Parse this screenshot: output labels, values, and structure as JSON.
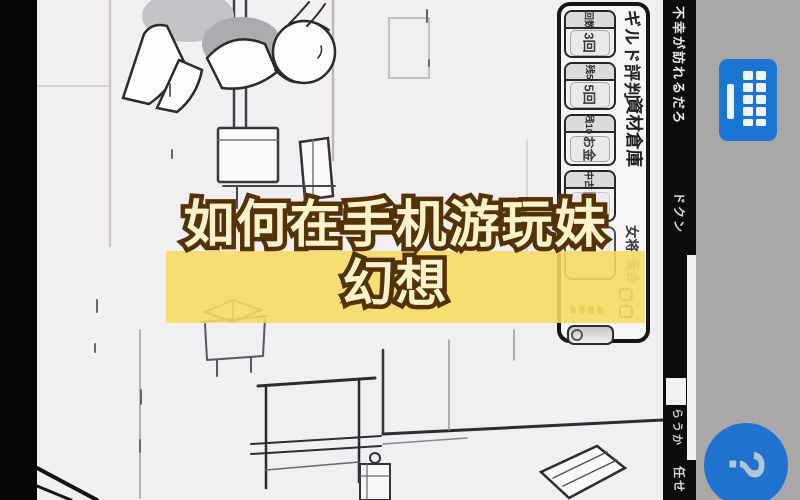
{
  "overlay": {
    "line1": "如何在手机游玩妹",
    "line2": "幻想",
    "band_color": "#f6db60"
  },
  "message_bar": {
    "top_text": "不幸が訪れるだろ",
    "mid_text": "ドクン",
    "low_text": "らうか",
    "bottom_text": "任せ"
  },
  "game_panel": {
    "title": "ギルド評判",
    "warehouse_label": "資材倉庫",
    "okami_label": "女将",
    "faint_label": "面会",
    "groups": [
      {
        "header": "回数",
        "label": "3回"
      },
      {
        "header": "残5",
        "label": "5回"
      },
      {
        "header": "残10",
        "label": "お金"
      },
      {
        "header": "中古",
        "label": "回復"
      }
    ]
  },
  "side_bar": {
    "keyboard_icon": "keyboard-icon",
    "help_glyph": "?"
  },
  "colors": {
    "accent_blue": "#1b76d3",
    "gray_bar": "#a9a7a8",
    "band_yellow": "#f6db60",
    "title_fill": "#fdf2cb",
    "title_outline": "#543208"
  }
}
